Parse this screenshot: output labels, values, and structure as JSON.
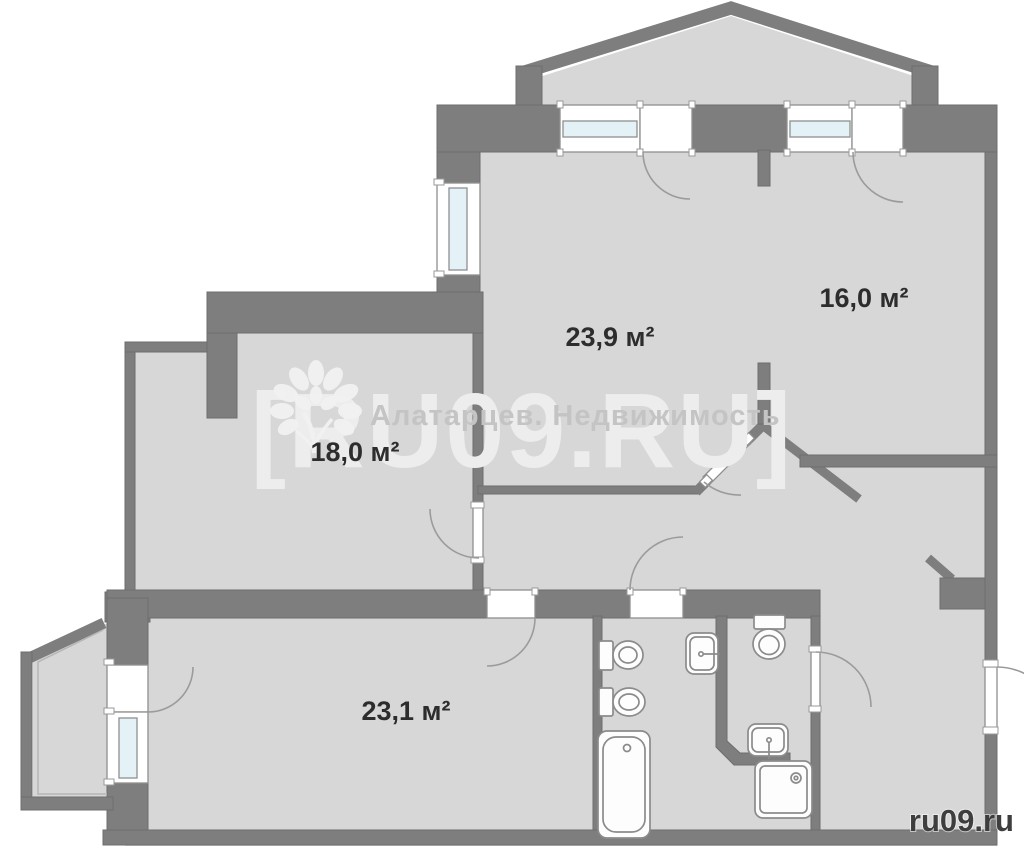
{
  "plan": {
    "rooms": [
      {
        "name": "room-top-left",
        "area_label": "23,9 м²"
      },
      {
        "name": "room-top-right",
        "area_label": "16,0 м²"
      },
      {
        "name": "room-mid-left",
        "area_label": "18,0 м²"
      },
      {
        "name": "room-bottom-left",
        "area_label": "23,1 м²"
      }
    ],
    "fixtures": [
      "toilet-icon",
      "bidet-icon",
      "bathtub-icon",
      "wall-sink-icon",
      "toilet-icon",
      "washbasin-icon",
      "shower-tray-icon"
    ]
  },
  "watermark": {
    "big_text": "[RU09.RU]",
    "agency_text": "Алатарцев. Недвижимость",
    "logo": "tree-icon",
    "corner_text": "ru09.ru"
  },
  "colors": {
    "wall": "#7e7e7e",
    "floor": "#d7d7d7",
    "glazing": "#e4f2f8",
    "fixture_outline": "#8b8b8b",
    "label_text": "#2d2d2d",
    "watermark_big": "#ededed",
    "watermark_agency": "#c4c4c4",
    "watermark_corner": "#3e3e3e"
  }
}
